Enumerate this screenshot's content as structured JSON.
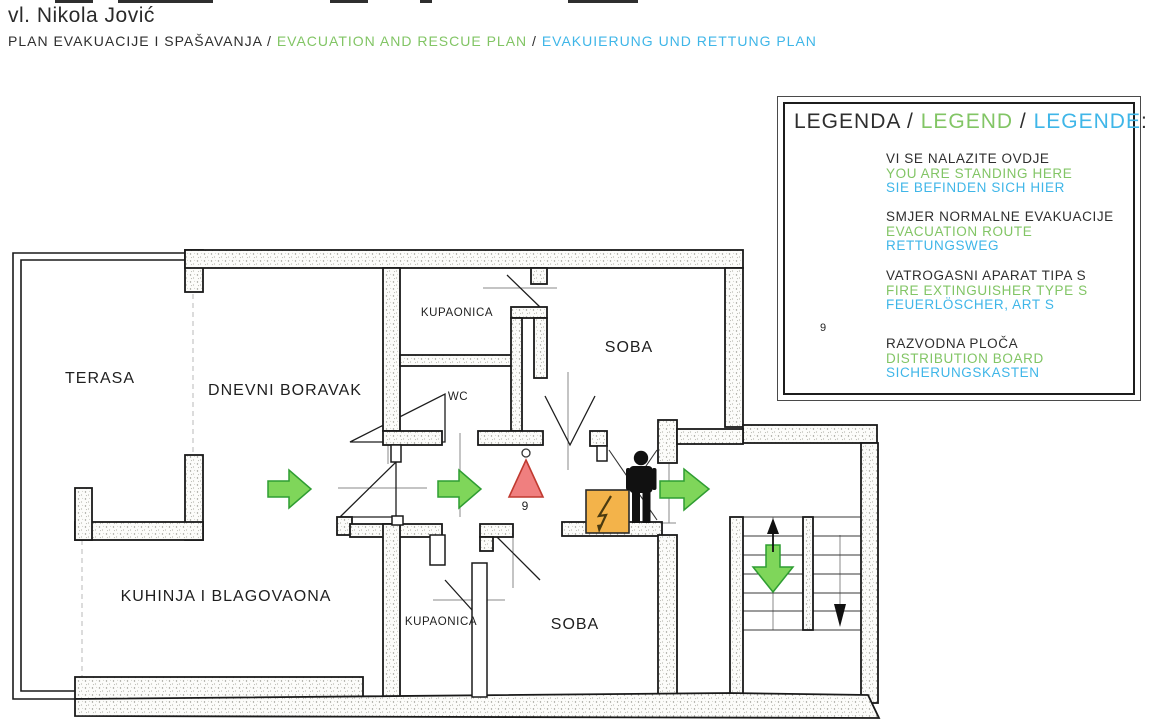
{
  "header": {
    "owner": "vl. Nikola Jović",
    "title_hr": "PLAN EVAKUACIJE I SPAŠAVANJA",
    "sep1": " / ",
    "title_en": "EVACUATION AND RESCUE PLAN",
    "sep2": " / ",
    "title_de": "EVAKUIERUNG UND RETTUNG PLAN"
  },
  "legend": {
    "title_hr": "LEGENDA",
    "title_sep1": " / ",
    "title_en": "LEGEND",
    "title_sep2": " / ",
    "title_de": "LEGENDE",
    "title_colon": ":",
    "items": [
      {
        "icon": "person-icon",
        "hr": "VI SE NALAZITE OVDJE",
        "en": "YOU ARE STANDING HERE",
        "de": "SIE BEFINDEN SICH HIER"
      },
      {
        "icon": "evacuation-arrow-icon",
        "hr": "SMJER NORMALNE EVAKUACIJE",
        "en": "EVACUATION ROUTE",
        "de": "RETTUNGSWEG"
      },
      {
        "icon": "fire-extinguisher-icon",
        "hr": "VATROGASNI APARAT TIPA S",
        "en": "FIRE EXTINGUISHER TYPE S",
        "de": "FEUERLÖSCHER, ART S",
        "badge": "9"
      },
      {
        "icon": "distribution-board-icon",
        "hr": "RAZVODNA PLOČA",
        "en": "DISTRIBUTION BOARD",
        "de": "SICHERUNGSKASTEN"
      }
    ]
  },
  "floorplan": {
    "rooms": [
      {
        "id": "terasa",
        "label": "TERASA"
      },
      {
        "id": "dnevni-boravak",
        "label": "DNEVNI BORAVAK"
      },
      {
        "id": "kupaonica-top",
        "label": "KUPAONICA"
      },
      {
        "id": "wc",
        "label": "WC"
      },
      {
        "id": "soba-top",
        "label": "SOBA"
      },
      {
        "id": "kuhinja",
        "label": "KUHINJA I BLAGOVAONA"
      },
      {
        "id": "kupaonica-bottom",
        "label": "KUPAONICA"
      },
      {
        "id": "soba-bottom",
        "label": "SOBA"
      }
    ],
    "extinguisher_label": "9"
  },
  "colors": {
    "text_green": "#82c565",
    "text_cyan": "#3fb6e8",
    "arrow_fill": "#7fd65a",
    "arrow_stroke": "#2f9d32",
    "extinguisher_fill": "#f07f7f",
    "extinguisher_stroke": "#c03a30",
    "board_fill": "#f3b34a",
    "wall_outline": "#1a1a1a"
  }
}
